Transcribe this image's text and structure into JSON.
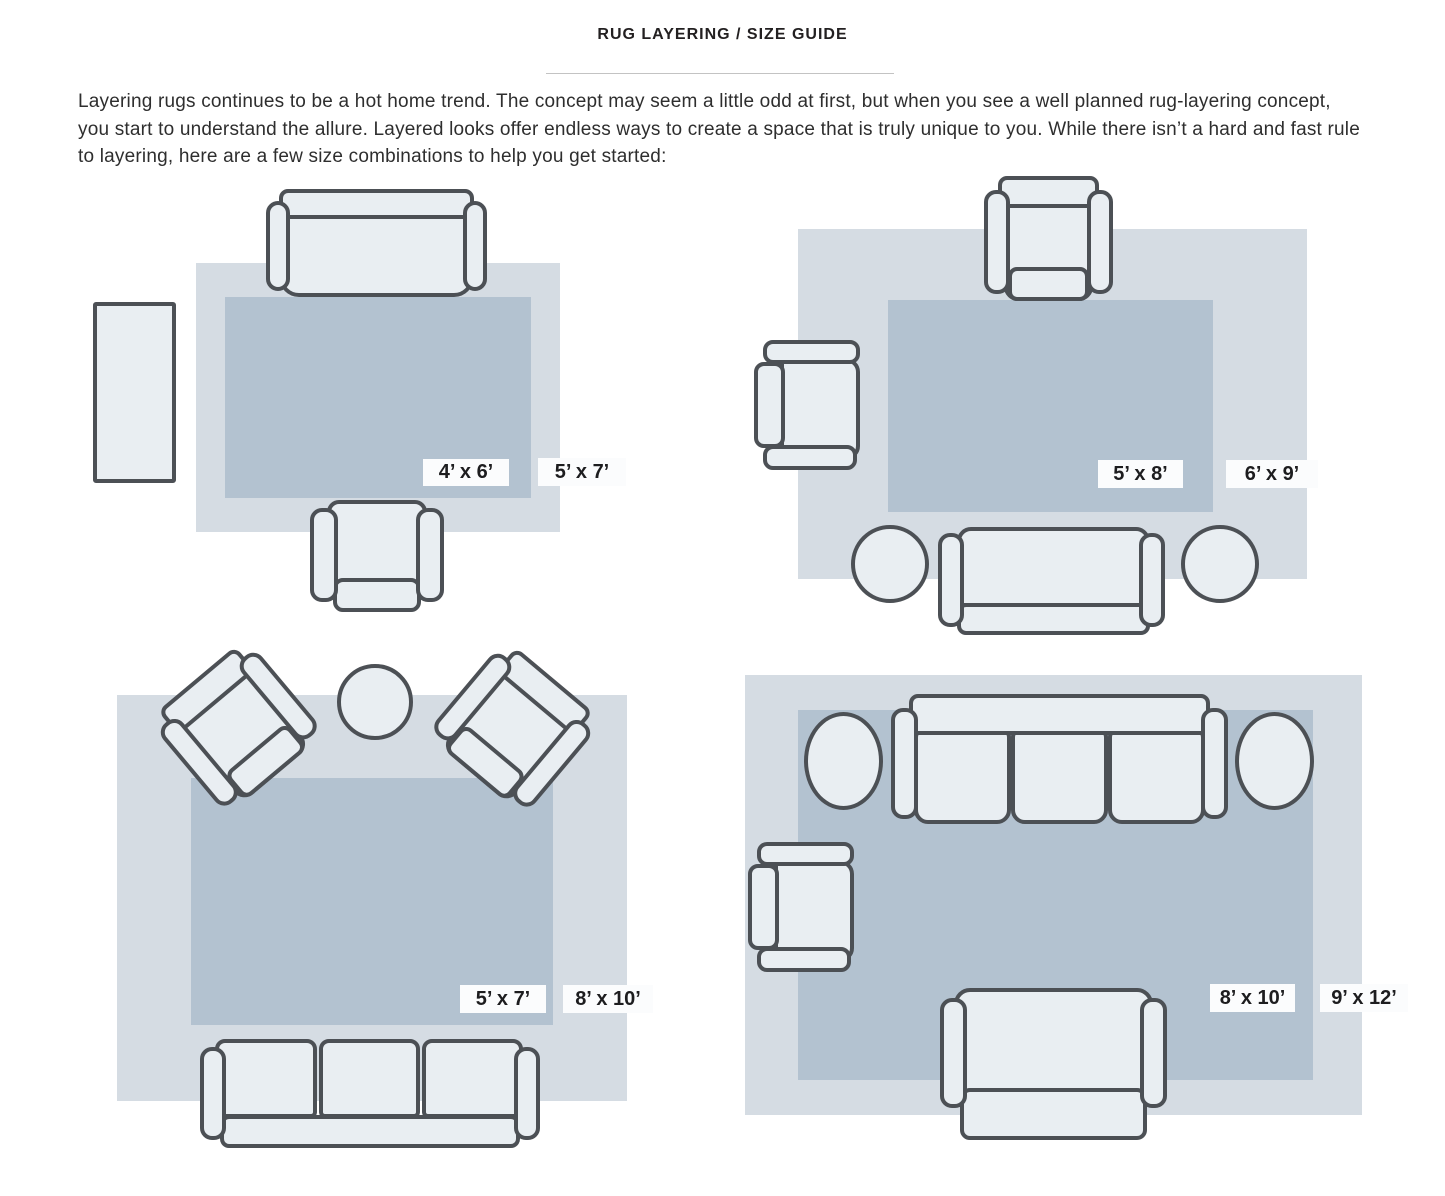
{
  "title": "RUG LAYERING / SIZE GUIDE",
  "intro": "Layering rugs continues to be a hot home trend. The concept may seem a little odd at first, but when you see a well planned rug-layering concept, you start to understand the allure. Layered looks offer endless ways to create a space that is truly unique to you. While there isn’t a hard and fast rule to layering, here are a few size combinations to help you get started:",
  "colors": {
    "outer_rug": "#d5dce3",
    "inner_rug": "#b3c2d0",
    "furniture_fill": "#e9eef2",
    "furniture_outline": "#4c5055",
    "label_bg": "#fbfcfd",
    "label_text": "#1d1d1f"
  },
  "diagrams": [
    {
      "position": "top-left",
      "inner_label": "4’ x 6’",
      "outer_label": "5’ x 7’",
      "furniture": [
        "sofa",
        "armchair",
        "side-table"
      ]
    },
    {
      "position": "top-right",
      "inner_label": "5’ x 8’",
      "outer_label": "6’ x 9’",
      "furniture": [
        "armchair",
        "armchair",
        "sofa",
        "round-table",
        "round-table"
      ]
    },
    {
      "position": "bottom-left",
      "inner_label": "5’ x 7’",
      "outer_label": "8’ x 10’",
      "furniture": [
        "angled-armchair",
        "angled-armchair",
        "round-table",
        "three-seat-sofa"
      ]
    },
    {
      "position": "bottom-right",
      "inner_label": "8’ x 10’",
      "outer_label": "9’ x 12’",
      "furniture": [
        "three-seat-sofa",
        "round-table",
        "round-table",
        "armchair",
        "loveseat"
      ]
    }
  ]
}
